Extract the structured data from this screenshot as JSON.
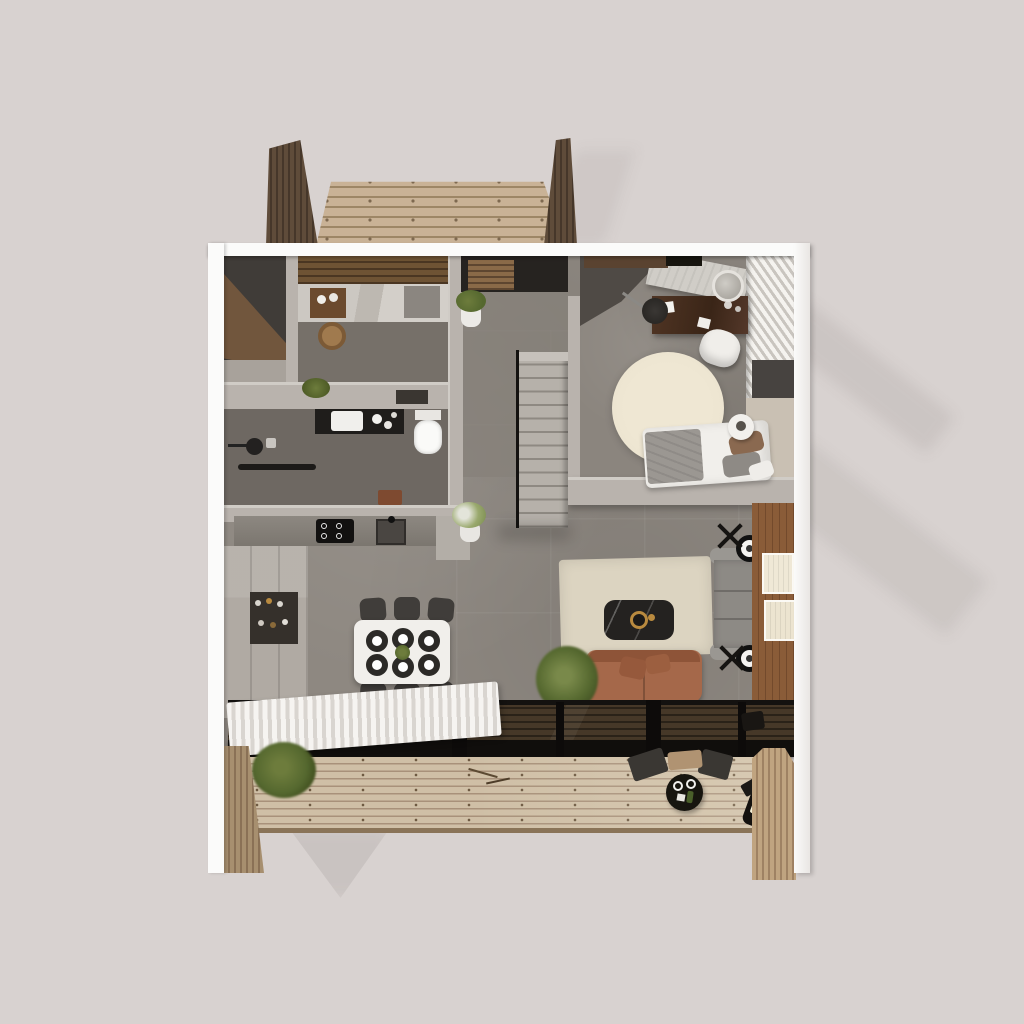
{
  "scene": {
    "type": "3d-floorplan-top-view-render",
    "background_color": "#d8d2d0",
    "frame_color": "#fbfbfa",
    "palette": {
      "bg": "#d8d2d0",
      "frame": "#fbfbfa",
      "floor": "#8e8881",
      "floor_dark": "#6e6862",
      "wall": "#b9b3ad",
      "wall_top": "#d0ccc6",
      "wall_dark": "#4f4a45",
      "deck_wood": "#c9b296",
      "deck_seam": "#9d8666",
      "slat_dark": "#5f4c3a",
      "slat_seam": "#46372a",
      "terrace_wood": "#cfbfa6",
      "terrace_seam": "#a8917a",
      "slatwall_light": "#8a755c",
      "accent_wood": "#8a5c38",
      "glass": "#1c1813",
      "rail": "#100e0c",
      "rug": "#dcd4c1",
      "rug_round": "#ece4d0",
      "sofa": "#8d8a85",
      "leather": "#a5684a",
      "marble": "#242220",
      "table_white": "#f1efeb",
      "chair_dark": "#403d3a",
      "plant": "#55682f",
      "walnut": "#462e1e",
      "bed": "#f1efeb",
      "stairs": "#b6b1aa"
    },
    "rooms": [
      "entry",
      "bathroom",
      "shower-room",
      "closet",
      "kitchen",
      "dining",
      "living-room",
      "bedroom",
      "terrace-top",
      "terrace-bottom"
    ],
    "objects": {
      "bed": "Double bed with white duvet and pillows",
      "round_rug": "Round cream rug",
      "desk": "Walnut desk",
      "desk_chair": "White desk chair",
      "mirror": "Round vanity mirror",
      "wardrobe": "Open wardrobe with hanging clothes",
      "dining_table": "White dining table with six place settings",
      "dining_chair": "Dark dining chair",
      "kitchen_counter": "Kitchen counter",
      "cooktop": "Black induction cooktop",
      "kitchen_sink": "Kitchen sink",
      "vanity_sink": "Bathroom vanity sink",
      "toilet": "Toilet",
      "shower": "Shower head",
      "towel_bar": "Black towel bar",
      "staircase": "Staircase with black railing",
      "sofa": "Gray sofa",
      "leather_sofa": "Cognac leather sofa",
      "coffee_table": "Dark marble coffee table",
      "floor_lamp": "Round floor lamp",
      "area_rug": "Cream area rug",
      "wood_wall": "Wood accent wall with framed art",
      "curtain": "White sheer curtain",
      "glass_wall": "Black framed glass wall",
      "terrace": "Wood plank terrace",
      "slat_wall": "Vertical wood slat wall",
      "plant": "Green potted plant",
      "outdoor_table": "Round black outdoor table",
      "outdoor_chair": "Dark outdoor chair",
      "wall_lamp": "Outdoor wall lamp",
      "entry_mat": "Wood entry mat",
      "basket": "Round woven basket",
      "marble_counter": "Marble bathroom counter"
    }
  }
}
